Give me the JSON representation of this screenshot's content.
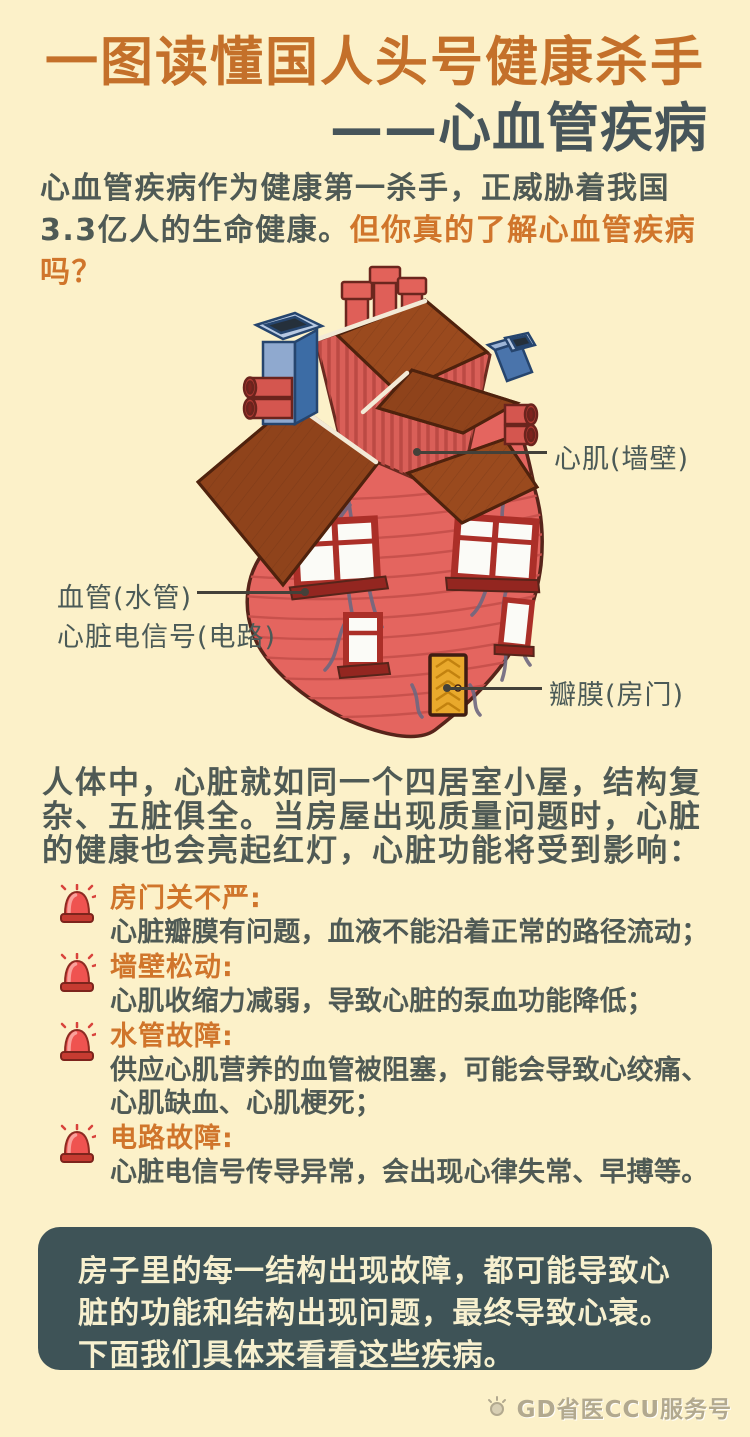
{
  "colors": {
    "background": "#fcf1c9",
    "title_orange": "#c4702a",
    "title_dark": "#47555a",
    "body_text": "#4f5a55",
    "accent_orange": "#d0752b",
    "box_background": "#3e5357",
    "box_text": "#f7f0cf",
    "siren_red": "#ef5350",
    "heart_red": "#e4655f",
    "roof_brown": "#9a4a1e",
    "chimney_blue": "#8fa9cf",
    "door_yellow": "#e9a92c",
    "vein_gray": "#6f6880",
    "footer_text": "#b2a98f"
  },
  "header": {
    "line1": "一图读懂国人头号健康杀手",
    "line2": "——心血管疾病"
  },
  "intro": {
    "lead": "心血管疾病作为健康第一杀手，正威胁着我国3.3亿人的生命健康。",
    "question": "但你真的了解心血管疾病吗？"
  },
  "illustration": {
    "labels": {
      "myocardium": "心肌(墙壁)",
      "vessel": "血管(水管)",
      "signal": "心脏电信号(电路)",
      "valve": "瓣膜(房门)"
    }
  },
  "analogy_paragraph": "人体中，心脏就如同一个四居室小屋，结构复杂、五脏俱全。当房屋出现质量问题时，心脏的健康也会亮起红灯，心脏功能将受到影响：",
  "problems": [
    {
      "title": "房门关不严:",
      "desc": "心脏瓣膜有问题，血液不能沿着正常的路径流动；"
    },
    {
      "title": "墙壁松动:",
      "desc": "心肌收缩力减弱，导致心脏的泵血功能降低；"
    },
    {
      "title": "水管故障:",
      "desc": "供应心肌营养的血管被阻塞，可能会导致心绞痛、心肌缺血、心肌梗死；"
    },
    {
      "title": "电路故障:",
      "desc": "心脏电信号传导异常，会出现心律失常、早搏等。"
    }
  ],
  "conclusion": {
    "text": "房子里的每一结构出现故障，都可能导致心脏的功能和结构出现问题，最终导致心衰。下面我们具体来看看这些疾病。"
  },
  "footer": {
    "account": "GD省医CCU服务号"
  }
}
